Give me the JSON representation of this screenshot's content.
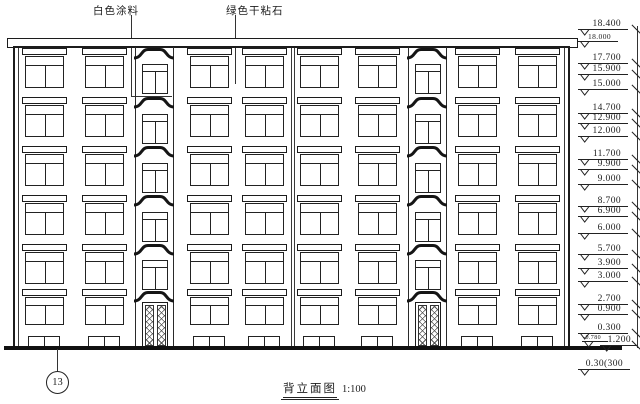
{
  "drawing": {
    "title": "背立面图",
    "scale": "1:100",
    "axis_bubble": "13",
    "material_labels": [
      {
        "text": "白色涂料"
      },
      {
        "text": "绿色干粘石"
      }
    ],
    "elevation_marks": [
      "18.400",
      "18.000",
      "17.700",
      "15.900",
      "15.000",
      "14.700",
      "12.900",
      "12.000",
      "11.700",
      "9.900",
      "9.000",
      "8.700",
      "6.900",
      "6.000",
      "5.700",
      "3.900",
      "3.000",
      "2.700",
      "0.900",
      "0.300",
      "-0.780",
      "1.200",
      "0.30(300"
    ],
    "line_color": "#1c1c1c",
    "bg_color": "#ffffff"
  },
  "building": {
    "floors": 6,
    "regular_window_columns": 8,
    "stair_bays": 2,
    "stair_windows_per_bay": 5,
    "entry_doors": 2,
    "basement_windows": 8
  }
}
